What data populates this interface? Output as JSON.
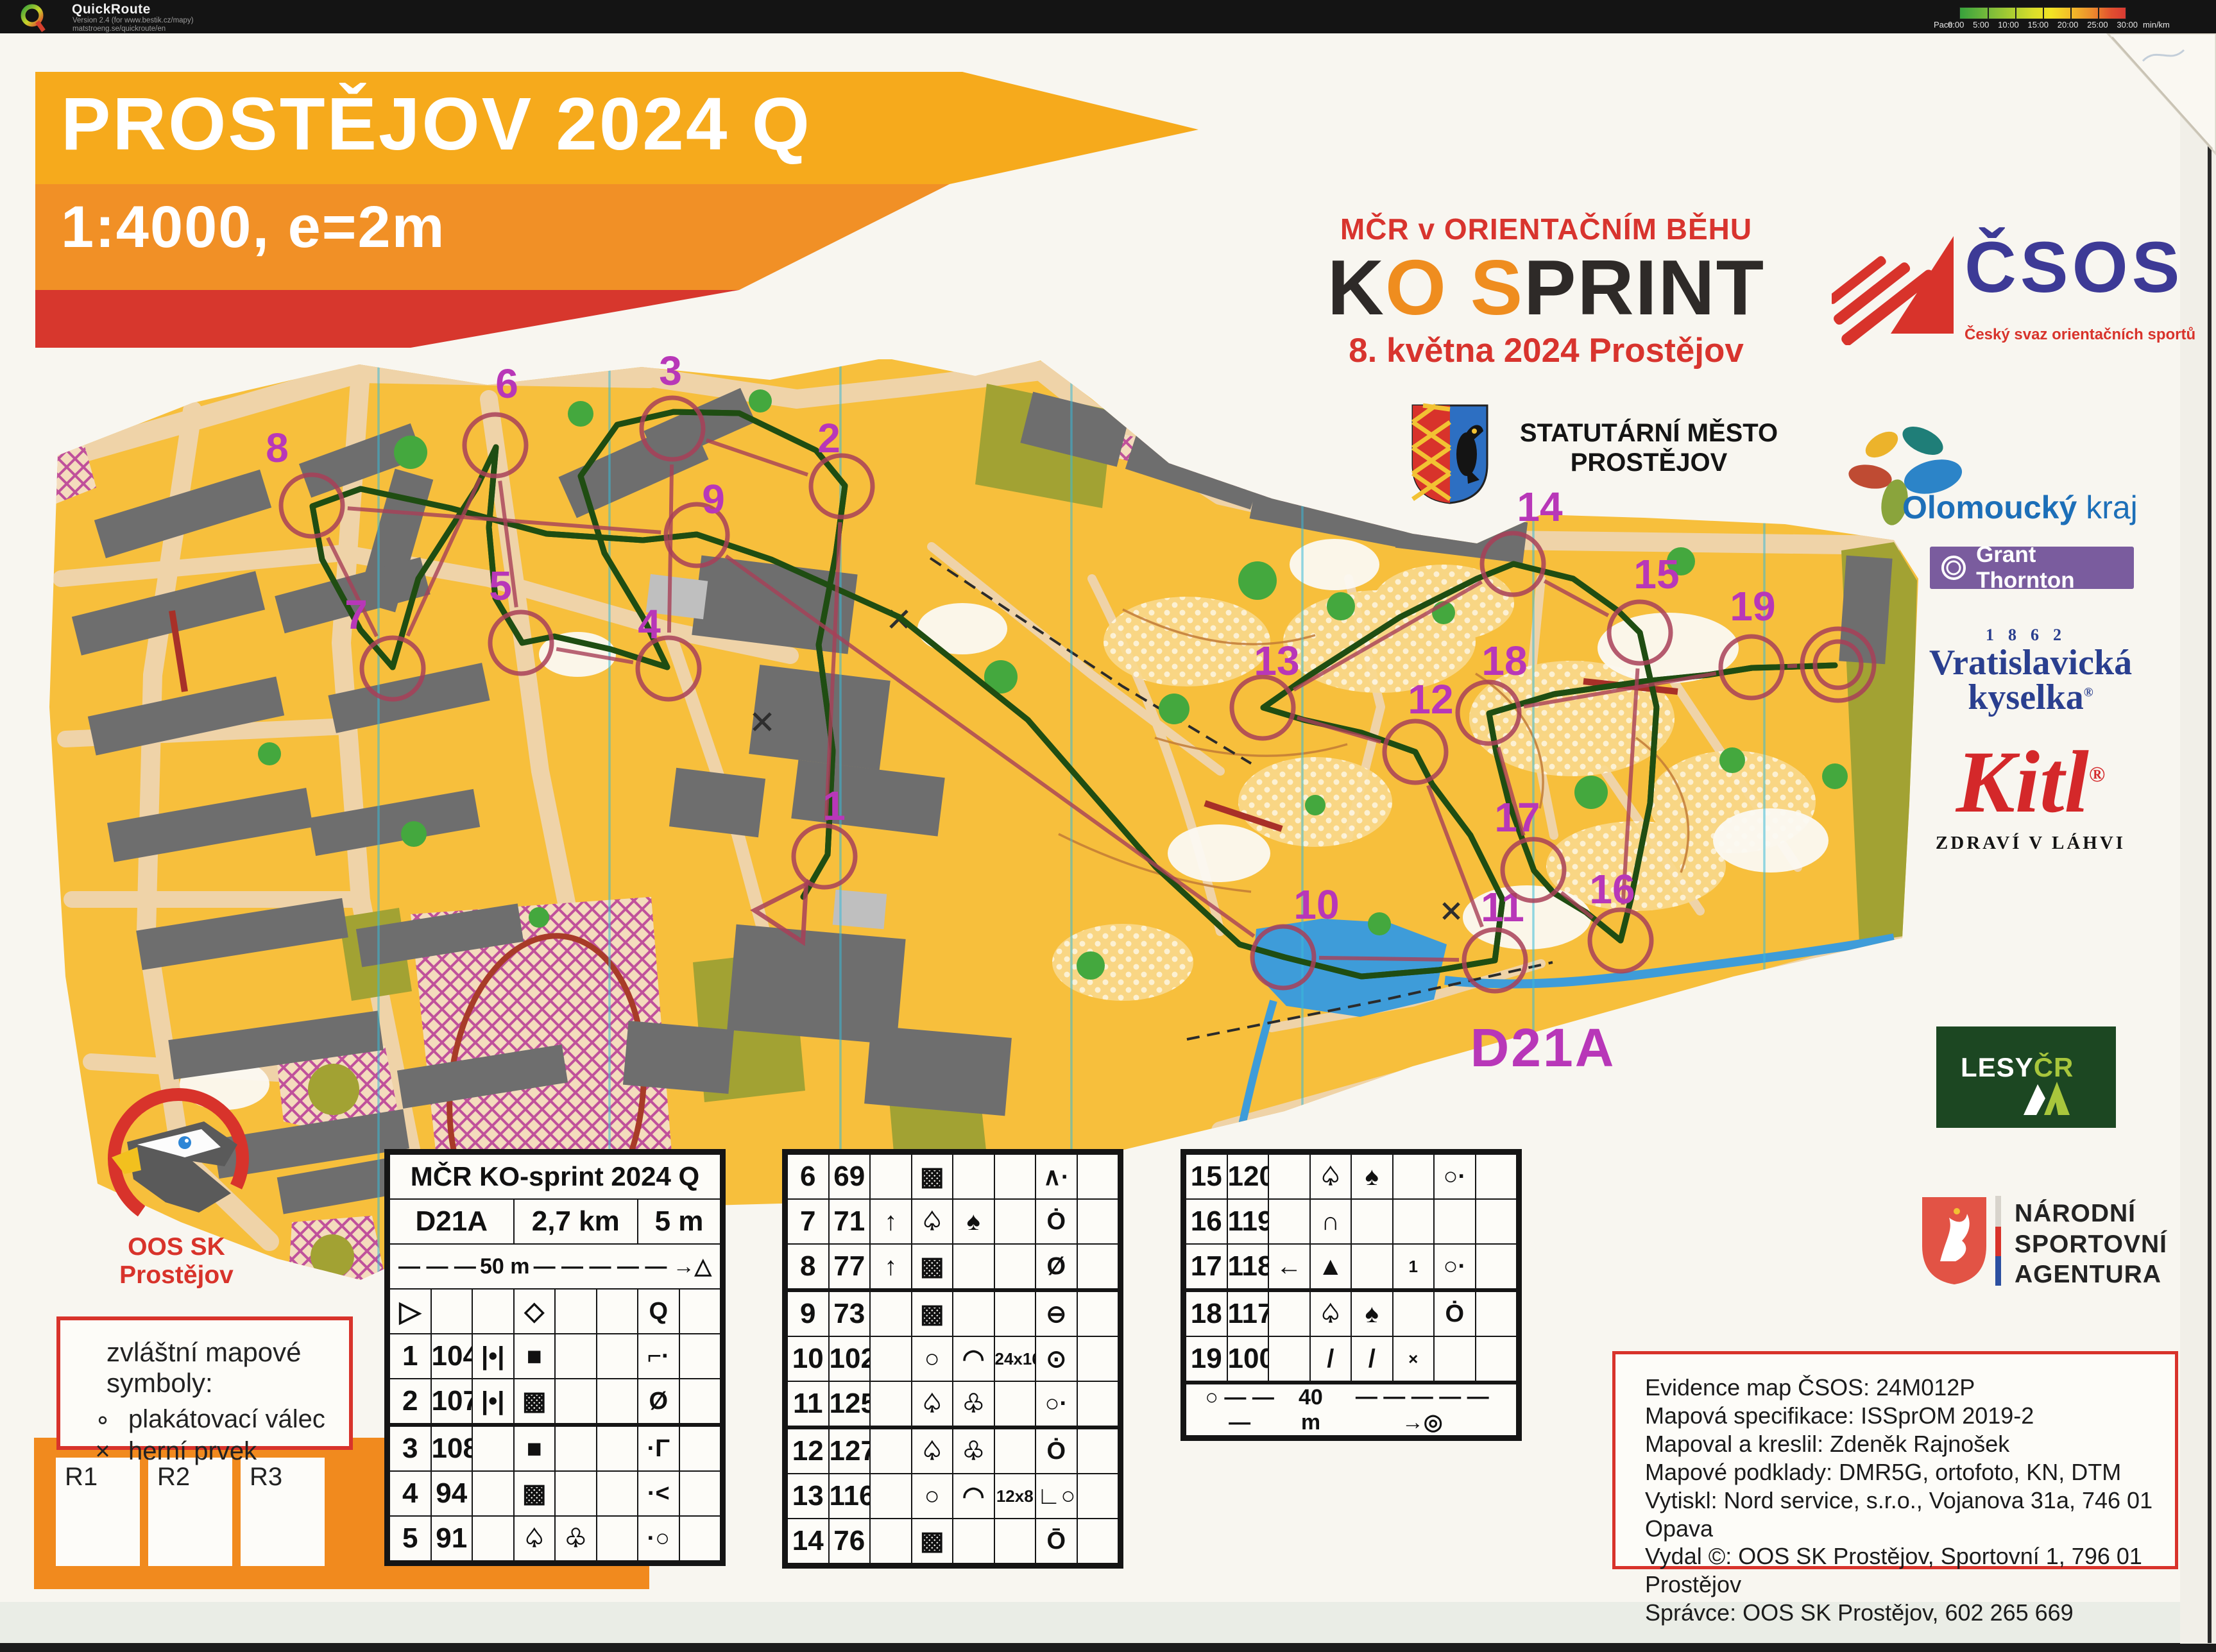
{
  "quickroute": {
    "app": "QuickRoute",
    "version_line": "Version 2.4  (for www.bestik.cz/mapy)",
    "url_line": "matstroeng.se/quickroute/en",
    "pace_label": "Pace",
    "pace_ticks": [
      "0:00",
      "5:00",
      "10:00",
      "15:00",
      "20:00",
      "25:00",
      "30:00"
    ],
    "pace_unit": "min/km"
  },
  "title": {
    "line1": "PROSTĚJOV 2024 Q",
    "line2": "1:4000, e=2m"
  },
  "event": {
    "header": "MČR v ORIENTAČNÍM BĚHU",
    "logo_k": "K",
    "logo_o": "O",
    "logo_s": "S",
    "logo_print": "PRINT",
    "date_line": "8. května 2024 Prostějov"
  },
  "logos": {
    "csos": {
      "name": "ČSOS",
      "subtitle": "Český svaz orientačních sportů"
    },
    "city": {
      "line1": "STATUTÁRNÍ MĚSTO",
      "line2": "PROSTĚJOV"
    },
    "region": {
      "bold": "Olomoucký",
      "regular": " kraj"
    },
    "grant": {
      "label": "Grant Thornton"
    },
    "kyselka": {
      "year": "1862",
      "line1": "Vratislavická",
      "line2": "kyselka",
      "reg": "®"
    },
    "kitl": {
      "name": "Kitl",
      "reg": "®",
      "tagline": "ZDRAVÍ V LÁHVI"
    },
    "lesy": {
      "lesy": "LESY",
      "cr": "ČR"
    },
    "nsa": {
      "line1": "NÁRODNÍ",
      "line2": "SPORTOVNÍ",
      "line3": "AGENTURA"
    },
    "club": {
      "name": "OOS SK Prostějov"
    }
  },
  "legend": {
    "title": "zvláštní mapové symboly:",
    "items": [
      {
        "symbol": "∘",
        "label": "plakátovací válec"
      },
      {
        "symbol": "×",
        "label": "herní prvek"
      }
    ]
  },
  "relay_boxes": [
    "R1",
    "R2",
    "R3"
  ],
  "descriptions": {
    "title": "MČR KO-sprint 2024 Q",
    "class": "D21A",
    "length": "2,7 km",
    "climb": "5 m",
    "scale_row": {
      "dashes": "— — —",
      "distance": "50 m",
      "arrow": "— — →",
      "end": "△"
    },
    "finish_row": {
      "start": "○",
      "dashes": "— — —",
      "distance": "40 m",
      "arrow": "— — →",
      "end": "◎"
    },
    "rows_left": [
      [
        "▷",
        "",
        "",
        "◇",
        "",
        "",
        "Q",
        ""
      ],
      [
        "1",
        "104",
        "|•|",
        "■",
        "",
        "",
        "⌐·",
        ""
      ],
      [
        "2",
        "107",
        "|•|",
        "▩",
        "",
        "",
        "Ø",
        ""
      ],
      [
        "3",
        "108",
        "",
        "■",
        "",
        "",
        "·Γ",
        ""
      ],
      [
        "4",
        "94",
        "",
        "▩",
        "",
        "",
        "·<",
        ""
      ],
      [
        "5",
        "91",
        "",
        "♤",
        "♧",
        "",
        "·○",
        ""
      ]
    ],
    "rows_mid": [
      [
        "6",
        "69",
        "",
        "▩",
        "",
        "",
        "∧·",
        ""
      ],
      [
        "7",
        "71",
        "↑",
        "♤",
        "♠",
        "",
        "Ȯ",
        ""
      ],
      [
        "8",
        "77",
        "↑",
        "▩",
        "",
        "",
        "Ø",
        ""
      ],
      [
        "9",
        "73",
        "",
        "▩",
        "",
        "",
        "⊖",
        ""
      ],
      [
        "10",
        "102",
        "",
        "○",
        "◠",
        "24x16",
        "⊙",
        ""
      ],
      [
        "11",
        "125",
        "",
        "♤",
        "♧",
        "",
        "○·",
        ""
      ],
      [
        "12",
        "127",
        "",
        "♤",
        "♧",
        "",
        "Ȯ",
        ""
      ],
      [
        "13",
        "116",
        "",
        "○",
        "◠",
        "12x8",
        "∟○",
        ""
      ],
      [
        "14",
        "76",
        "",
        "▩",
        "",
        "",
        "Ō",
        ""
      ]
    ],
    "rows_right": [
      [
        "15",
        "120",
        "",
        "♤",
        "♠",
        "",
        "○·",
        ""
      ],
      [
        "16",
        "119",
        "",
        "∩",
        "",
        "",
        "",
        ""
      ],
      [
        "17",
        "118",
        "←",
        "▲",
        "",
        "1",
        "○·",
        ""
      ],
      [
        "18",
        "117",
        "",
        "♤",
        "♠",
        "",
        "Ȯ",
        ""
      ],
      [
        "19",
        "100",
        "",
        "/",
        "/",
        "×",
        "",
        ""
      ]
    ]
  },
  "map": {
    "class_label": "D21A",
    "class_label_pos": [
      2405,
      1662
    ],
    "course_color": "#A84058",
    "number_color": "#B837B8",
    "start": [
      1228,
      1422
    ],
    "finish": [
      2865,
      1036
    ],
    "controls": [
      {
        "n": "1",
        "label": [
          1300,
          1278
        ],
        "circle": [
          1285,
          1335
        ]
      },
      {
        "n": "2",
        "label": [
          1292,
          705
        ],
        "circle": [
          1312,
          758
        ]
      },
      {
        "n": "3",
        "label": [
          1045,
          600
        ],
        "circle": [
          1048,
          668
        ]
      },
      {
        "n": "4",
        "label": [
          1012,
          995
        ],
        "circle": [
          1042,
          1042
        ]
      },
      {
        "n": "5",
        "label": [
          780,
          935
        ],
        "circle": [
          812,
          1002
        ]
      },
      {
        "n": "6",
        "label": [
          790,
          620
        ],
        "circle": [
          772,
          694
        ]
      },
      {
        "n": "7",
        "label": [
          555,
          980
        ],
        "circle": [
          612,
          1042
        ]
      },
      {
        "n": "8",
        "label": [
          432,
          720
        ],
        "circle": [
          486,
          788
        ]
      },
      {
        "n": "9",
        "label": [
          1112,
          800
        ],
        "circle": [
          1086,
          834
        ]
      },
      {
        "n": "10",
        "label": [
          2052,
          1432
        ],
        "circle": [
          2000,
          1492
        ]
      },
      {
        "n": "11",
        "label": [
          2342,
          1436
        ],
        "circle": [
          2330,
          1497
        ]
      },
      {
        "n": "12",
        "label": [
          2230,
          1112
        ],
        "circle": [
          2206,
          1172
        ]
      },
      {
        "n": "13",
        "label": [
          1990,
          1052
        ],
        "circle": [
          1968,
          1103
        ]
      },
      {
        "n": "14",
        "label": [
          2400,
          812
        ],
        "circle": [
          2358,
          879
        ]
      },
      {
        "n": "15",
        "label": [
          2582,
          917
        ],
        "circle": [
          2556,
          986
        ]
      },
      {
        "n": "16",
        "label": [
          2513,
          1408
        ],
        "circle": [
          2526,
          1466
        ]
      },
      {
        "n": "17",
        "label": [
          2365,
          1296
        ],
        "circle": [
          2390,
          1356
        ]
      },
      {
        "n": "18",
        "label": [
          2345,
          1052
        ],
        "circle": [
          2320,
          1111
        ]
      },
      {
        "n": "19",
        "label": [
          2732,
          967
        ],
        "circle": [
          2730,
          1040
        ]
      }
    ]
  },
  "credits": {
    "lines": [
      "Evidence map ČSOS: 24M012P",
      "Mapová specifikace: ISSprOM 2019-2",
      "Mapoval a kreslil: Zdeněk Rajnošek",
      "Mapové podklady: DMR5G, ortofoto, KN, DTM",
      "Vytiskl: Nord service, s.r.o., Vojanova 31a, 746 01 Opava",
      "Vydal ©: OOS SK Prostějov, Sportovní 1, 796 01 Prostějov",
      "Správce: OOS SK Prostějov, 602 265 669"
    ]
  }
}
